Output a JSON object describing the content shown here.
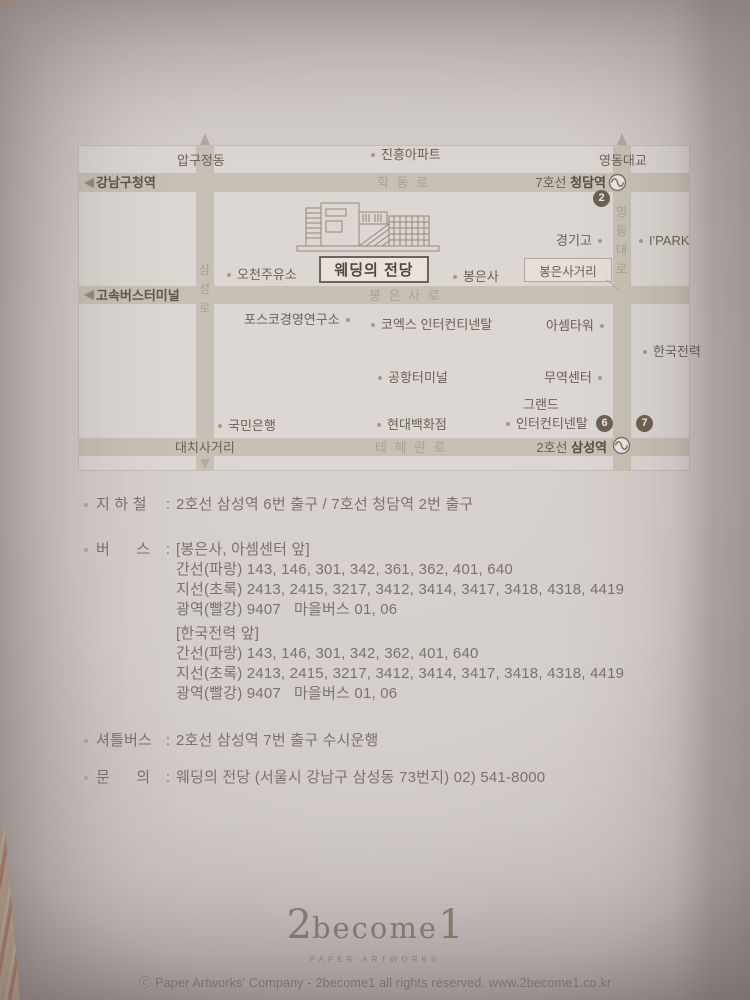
{
  "map": {
    "edge": {
      "apgujeongdong": "압구정동",
      "jinheung_apt": "진흥아파트",
      "yeongdong_bridge": "영동대교"
    },
    "stations": {
      "gangnamgu_office": "강남구청역",
      "express_bus_terminal": "고속버스터미널",
      "cheongdam_line": "7호선 ",
      "cheongdam_name": "청담역",
      "samseong_line": "2호선 ",
      "samseong_name": "삼성역"
    },
    "roads": {
      "hakdong": "학 동 로",
      "bongeunsa": "봉 은 사 로",
      "teheran": "테 헤 란 로",
      "daechi_junction": "대치사거리",
      "samseong_ro": [
        "삼",
        "성",
        "로"
      ],
      "yeongdong_daero": [
        "영",
        "동",
        "대",
        "로"
      ]
    },
    "places": {
      "ocheon_gas": "오천주유소",
      "bongeunsa_temple": "봉은사",
      "kyunggi_high": "경기고",
      "ipark": "I'PARK",
      "posco_research": "포스코경영연구소",
      "coex_intercontinental": "코엑스 인터컨티넨탈",
      "asem_tower": "아셈타워",
      "kepco": "한국전력",
      "airport_terminal": "공항터미널",
      "trade_center": "무역센터",
      "grand_line1": "그랜드",
      "grand_line2": "인터컨티넨탈",
      "hyundai_dept": "현대백화점",
      "kookmin_bank": "국민은행"
    },
    "venue": {
      "name": "웨딩의 전당"
    },
    "callout": {
      "bongeunsa_junction": "봉은사거리"
    },
    "badges": {
      "exit2": "2",
      "exit6": "6",
      "exit7": "7"
    }
  },
  "directions": {
    "colon": ":",
    "subway": {
      "label": "지 하 철",
      "value": "2호선 삼성역 6번 출구 / 7호선 청담역 2번 출구"
    },
    "bus": {
      "label": "버      스",
      "groups": [
        {
          "location": "[봉은사, 아셈센터 앞]",
          "lines": [
            "간선(파랑) 143, 146, 301, 342, 361, 362, 401, 640",
            "지선(초록) 2413, 2415, 3217, 3412, 3414, 3417, 3418, 4318, 4419",
            "광역(빨강) 9407   마을버스 01, 06"
          ]
        },
        {
          "location": "[한국전력 앞]",
          "lines": [
            "간선(파랑) 143, 146, 301, 342, 362, 401, 640",
            "지선(초록) 2413, 2415, 3217, 3412, 3414, 3417, 3418, 4318, 4419",
            "광역(빨강) 9407   마을버스 01, 06"
          ]
        }
      ]
    },
    "shuttle": {
      "label": "셔틀버스",
      "value": "2호선 삼성역 7번 출구 수시운행"
    },
    "inquiry": {
      "label": "문      의",
      "value": "웨딩의 전당 (서울시 강남구 삼성동 73번지) 02) 541-8000"
    }
  },
  "footer": {
    "logo_prefix": "2",
    "logo_mid": "become",
    "logo_suffix": "1",
    "logo_subtitle": "PAPER ARTWORKS",
    "copyright": "ⓒ Paper Artworks' Company - 2become1 all rights reserved.   www.2become1.co.kr"
  }
}
